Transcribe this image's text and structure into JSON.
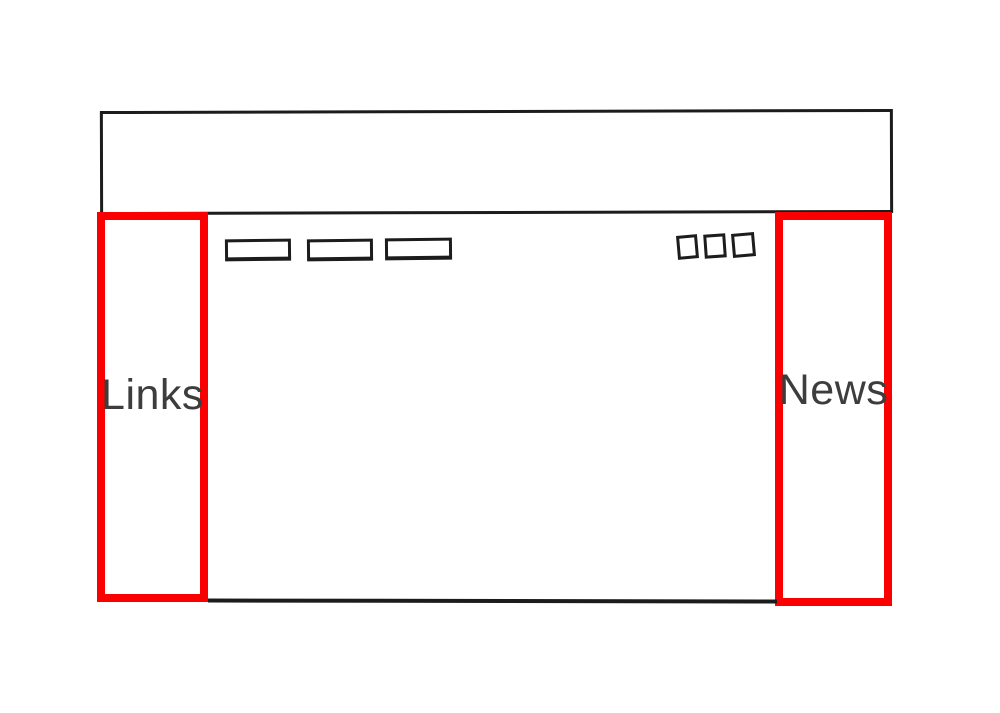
{
  "diagram": {
    "type": "website-layout-wireframe",
    "labels": {
      "left_sidebar": "Links",
      "right_sidebar": "News"
    },
    "colors": {
      "background": "#ffffff",
      "outline": "#1c1c1c",
      "highlight": "#fb0000",
      "label_text": "#3d3d3d"
    },
    "shapes": {
      "nav_button_count": 3,
      "icon_square_count": 3
    }
  }
}
